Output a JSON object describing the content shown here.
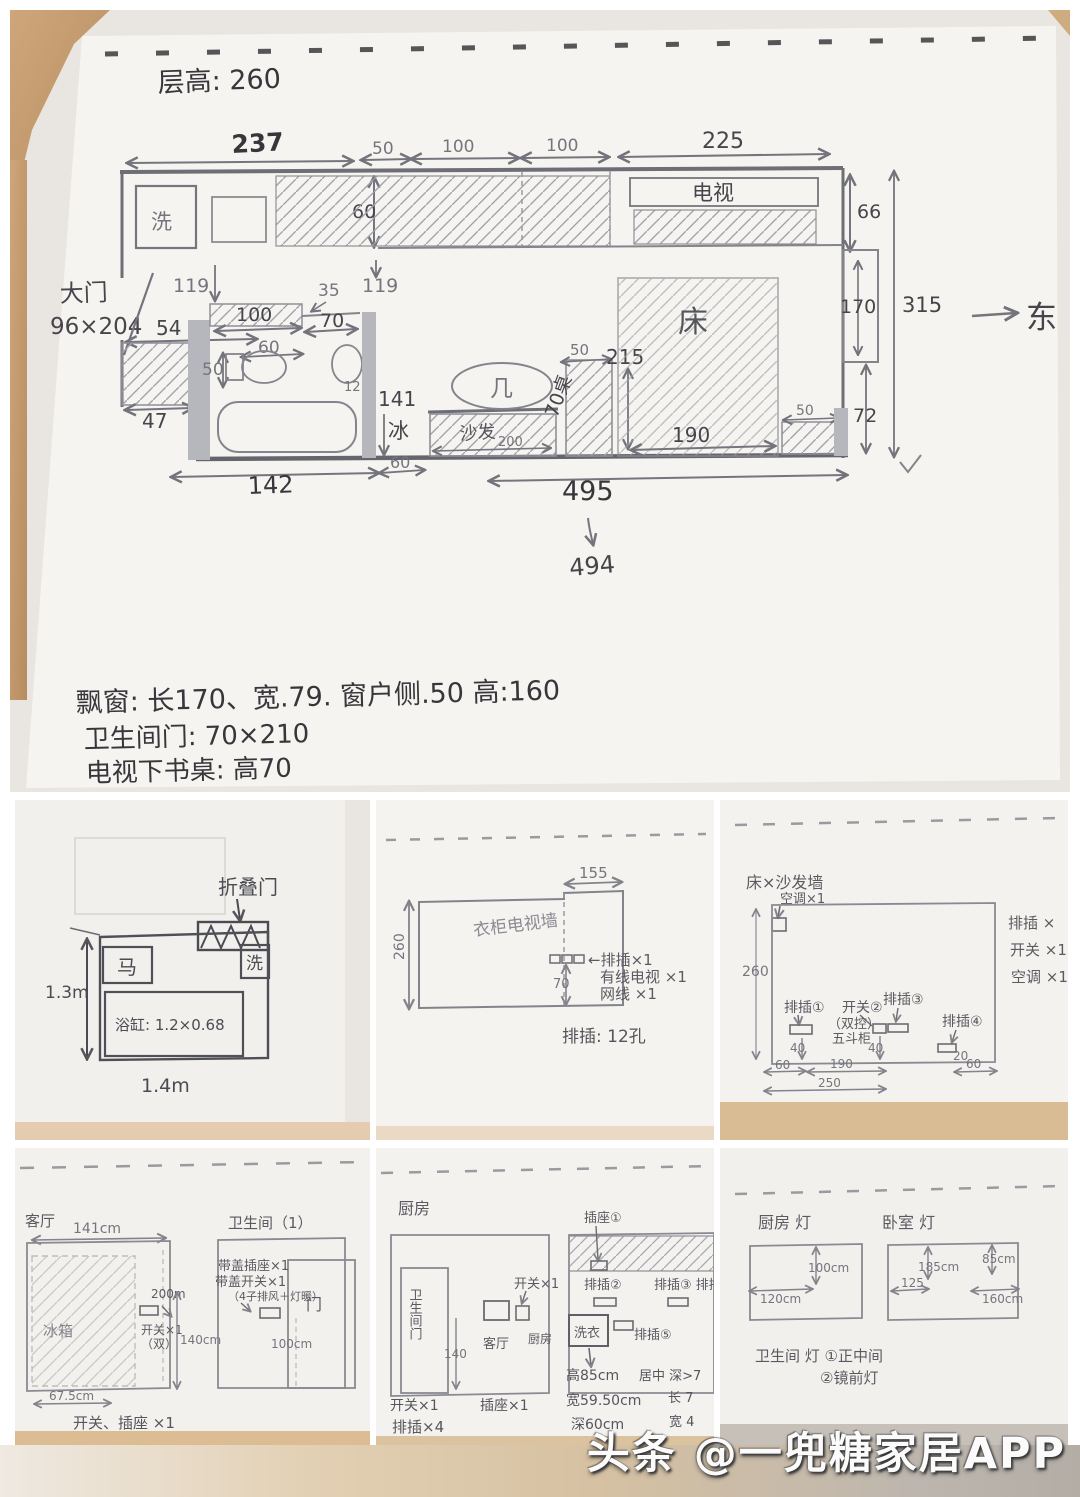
{
  "watermark": "头条 @一兜糖家居APP",
  "main": {
    "ceiling": "层高: 260",
    "east": "东",
    "washer": "洗",
    "tv": "电视",
    "door_label": "大门",
    "door_size": "96×204",
    "fridge": "冰",
    "table": "几",
    "sofa": "沙发",
    "desk": "70桌",
    "bed": "床",
    "dims": {
      "w237": "237",
      "w50": "50",
      "w100a": "100",
      "w100b": "100",
      "w225": "225",
      "h60": "60",
      "h66": "66",
      "v119a": "119",
      "v119b": "119",
      "d35": "35",
      "d70": "70",
      "d54": "54",
      "d100": "100",
      "d60": "60",
      "d50": "50",
      "d12": "12",
      "d47": "47",
      "d141": "141",
      "d142": "142",
      "b60": "60",
      "s200": "200",
      "t50": "50",
      "d215": "215",
      "d190": "190",
      "r50": "50",
      "r72": "72",
      "r170": "170",
      "r315": "315",
      "w495": "495",
      "w494": "494"
    },
    "notes": [
      "飘窗: 长170、宽.79. 窗户侧.50 高:160",
      "卫生间门: 70×210",
      "电视下书桌: 高70"
    ]
  },
  "bath": {
    "folding_door": "折叠门",
    "toilet": "马",
    "sink": "洗",
    "tub": "浴缸: 1.2×0.68",
    "h": "1.3m",
    "w": "1.4m"
  },
  "tvwall": {
    "w155": "155",
    "h260": "260",
    "title": "衣柜电视墙",
    "strip": "←排插×1",
    "cable": "有线电视 ×1",
    "net": "网线 ×1",
    "h70": "70",
    "note": "排插: 12孔"
  },
  "sofawall": {
    "title": "床×沙发墙",
    "ac_top": "空调×1",
    "h260": "260",
    "list": [
      "排插 ×",
      "开关 ×1",
      "空调 ×1"
    ],
    "p1": "排插①",
    "sw": "开关②",
    "dual": "（双控）",
    "cab": "五斗柜",
    "p3": "排插③",
    "p4": "排插④",
    "d40a": "40",
    "d40b": "40",
    "d20": "20",
    "d60a": "60",
    "d190": "190",
    "d60b": "60",
    "d250": "250"
  },
  "fridgepanel": {
    "room": "客厅",
    "w141": "141cm",
    "fridge": "冰箱",
    "d200": "200m",
    "sw": "开关×1",
    "dual": "（双）",
    "h140": "140cm",
    "bath_title": "卫生间（1）",
    "socket": "带盖插座×1",
    "switch": "带盖开关×1",
    "note": "（4子排风＋灯暖）",
    "door": "门",
    "h100": "100cm",
    "w67": "67.5cm",
    "bottom": "开关、插座 ×1"
  },
  "kitchen": {
    "title": "厨房",
    "bath_door": "卫生间门",
    "d140": "140",
    "sw1": "开关×1",
    "living": "客厅",
    "kitchen2": "厨房",
    "s1": "插座①",
    "p2": "排插②",
    "p34": "排插③ 排插④",
    "washer": "洗衣",
    "p5": "排插⑤",
    "h85": "高85cm",
    "w595": "宽59.50cm",
    "d60": "深60cm",
    "mid": "居中 深>7",
    "len": "长 7",
    "wid": "宽 4",
    "bottom1": "开关×1",
    "bottom2": "排插×4",
    "bottom3": "插座×1"
  },
  "lights": {
    "kitchen": "厨房 灯",
    "bedroom": "卧室 灯",
    "d100": "100cm",
    "d120": "120cm",
    "d185": "185cm",
    "d85": "85cm",
    "d125": "125",
    "d160": "160cm",
    "note1": "卫生间 灯 ①正中间",
    "note2": "②镜前灯"
  }
}
